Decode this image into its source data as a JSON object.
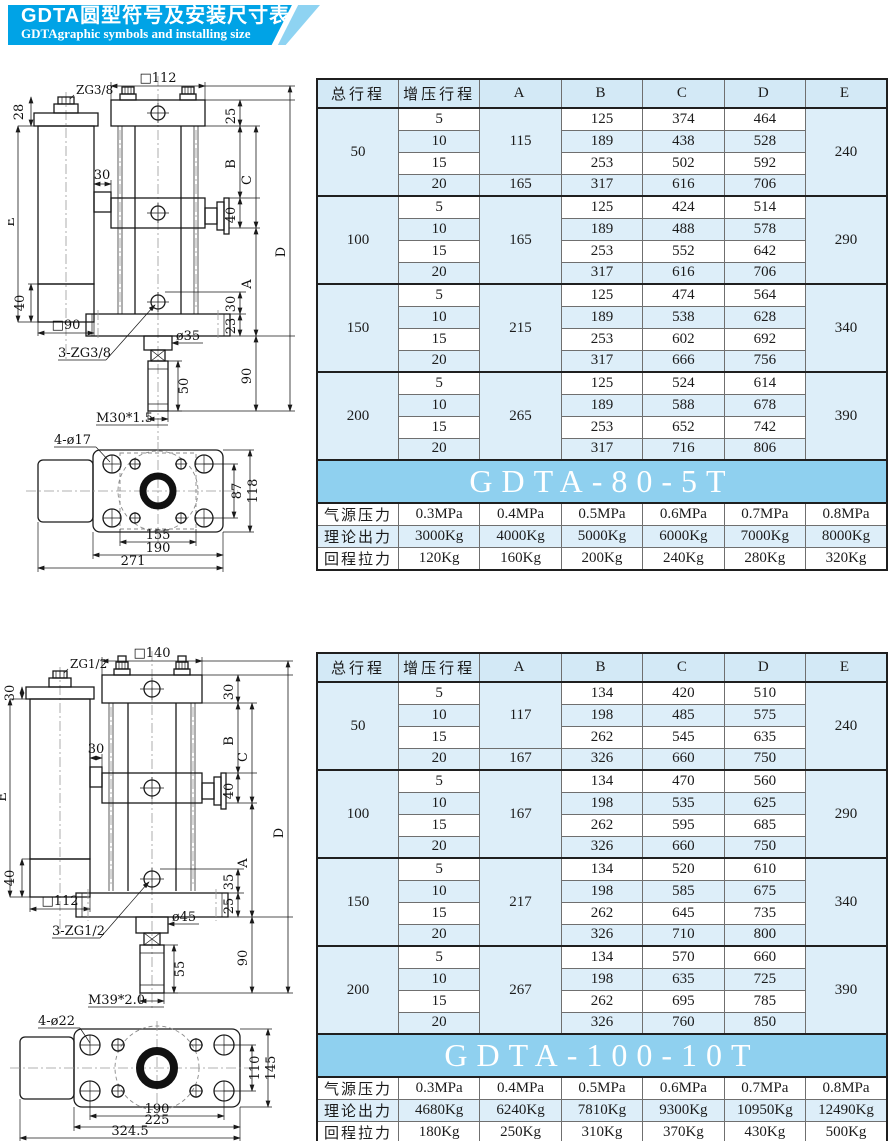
{
  "header": {
    "title_cn": "GDTA圆型符号及安装尺寸表",
    "title_en": "GDTAgraphic symbols and installing size"
  },
  "colors": {
    "header_blue": "#00a3e6",
    "header_triangle": "#8ed3f2",
    "table_header_bg": "#d3e9f6",
    "row_alt_bg": "#ddeef9",
    "banner_bg": "#8fd0ef",
    "line": "#1a1a1a"
  },
  "tables": [
    {
      "columns": [
        "总行程",
        "增压行程",
        "A",
        "B",
        "C",
        "D",
        "E"
      ],
      "groups": [
        {
          "total": "50",
          "e": "240",
          "a_cells": [
            {
              "v": "115",
              "span": 3
            },
            {
              "v": "165",
              "span": 1
            }
          ],
          "rows": [
            [
              "5",
              "125",
              "374",
              "464"
            ],
            [
              "10",
              "189",
              "438",
              "528"
            ],
            [
              "15",
              "253",
              "502",
              "592"
            ],
            [
              "20",
              "317",
              "616",
              "706"
            ]
          ]
        },
        {
          "total": "100",
          "e": "290",
          "a_cells": [
            {
              "v": "165",
              "span": 4
            }
          ],
          "rows": [
            [
              "5",
              "125",
              "424",
              "514"
            ],
            [
              "10",
              "189",
              "488",
              "578"
            ],
            [
              "15",
              "253",
              "552",
              "642"
            ],
            [
              "20",
              "317",
              "616",
              "706"
            ]
          ]
        },
        {
          "total": "150",
          "e": "340",
          "a_cells": [
            {
              "v": "215",
              "span": 4
            }
          ],
          "rows": [
            [
              "5",
              "125",
              "474",
              "564"
            ],
            [
              "10",
              "189",
              "538",
              "628"
            ],
            [
              "15",
              "253",
              "602",
              "692"
            ],
            [
              "20",
              "317",
              "666",
              "756"
            ]
          ]
        },
        {
          "total": "200",
          "e": "390",
          "a_cells": [
            {
              "v": "265",
              "span": 4
            }
          ],
          "rows": [
            [
              "5",
              "125",
              "524",
              "614"
            ],
            [
              "10",
              "189",
              "588",
              "678"
            ],
            [
              "15",
              "253",
              "652",
              "742"
            ],
            [
              "20",
              "317",
              "716",
              "806"
            ]
          ]
        }
      ],
      "model": "GDTA-80-5T",
      "specs": [
        {
          "label": "气源压力",
          "values": [
            "0.3MPa",
            "0.4MPa",
            "0.5MPa",
            "0.6MPa",
            "0.7MPa",
            "0.8MPa"
          ]
        },
        {
          "label": "理论出力",
          "values": [
            "3000Kg",
            "4000Kg",
            "5000Kg",
            "6000Kg",
            "7000Kg",
            "8000Kg"
          ]
        },
        {
          "label": "回程拉力",
          "values": [
            "120Kg",
            "160Kg",
            "200Kg",
            "240Kg",
            "280Kg",
            "320Kg"
          ]
        }
      ]
    },
    {
      "columns": [
        "总行程",
        "增压行程",
        "A",
        "B",
        "C",
        "D",
        "E"
      ],
      "groups": [
        {
          "total": "50",
          "e": "240",
          "a_cells": [
            {
              "v": "117",
              "span": 3
            },
            {
              "v": "167",
              "span": 1
            }
          ],
          "rows": [
            [
              "5",
              "134",
              "420",
              "510"
            ],
            [
              "10",
              "198",
              "485",
              "575"
            ],
            [
              "15",
              "262",
              "545",
              "635"
            ],
            [
              "20",
              "326",
              "660",
              "750"
            ]
          ]
        },
        {
          "total": "100",
          "e": "290",
          "a_cells": [
            {
              "v": "167",
              "span": 4
            }
          ],
          "rows": [
            [
              "5",
              "134",
              "470",
              "560"
            ],
            [
              "10",
              "198",
              "535",
              "625"
            ],
            [
              "15",
              "262",
              "595",
              "685"
            ],
            [
              "20",
              "326",
              "660",
              "750"
            ]
          ]
        },
        {
          "total": "150",
          "e": "340",
          "a_cells": [
            {
              "v": "217",
              "span": 4
            }
          ],
          "rows": [
            [
              "5",
              "134",
              "520",
              "610"
            ],
            [
              "10",
              "198",
              "585",
              "675"
            ],
            [
              "15",
              "262",
              "645",
              "735"
            ],
            [
              "20",
              "326",
              "710",
              "800"
            ]
          ]
        },
        {
          "total": "200",
          "e": "390",
          "a_cells": [
            {
              "v": "267",
              "span": 4
            }
          ],
          "rows": [
            [
              "5",
              "134",
              "570",
              "660"
            ],
            [
              "10",
              "198",
              "635",
              "725"
            ],
            [
              "15",
              "262",
              "695",
              "785"
            ],
            [
              "20",
              "326",
              "760",
              "850"
            ]
          ]
        }
      ],
      "model": "GDTA-100-10T",
      "specs": [
        {
          "label": "气源压力",
          "values": [
            "0.3MPa",
            "0.4MPa",
            "0.5MPa",
            "0.6MPa",
            "0.7MPa",
            "0.8MPa"
          ]
        },
        {
          "label": "理论出力",
          "values": [
            "4680Kg",
            "6240Kg",
            "7810Kg",
            "9300Kg",
            "10950Kg",
            "12490Kg"
          ]
        },
        {
          "label": "回程拉力",
          "values": [
            "180Kg",
            "250Kg",
            "310Kg",
            "370Kg",
            "430Kg",
            "500Kg"
          ]
        }
      ]
    }
  ],
  "drawings": [
    {
      "labels": {
        "zg_top": "ZG3/8",
        "sq_top": "□112",
        "d28": "28",
        "d25": "25",
        "d30_mid": "30",
        "dB": "B",
        "d40_gauge": "40",
        "dC": "C",
        "dD": "D",
        "dE": "E",
        "dA": "A",
        "d40_tank": "40",
        "sq_tank": "□90",
        "ports": "3-ZG3/8",
        "rod_d": "ø35",
        "rod_l": "50",
        "d30_b": "30",
        "d23": "23",
        "d90": "90",
        "thread": "M30*1.5",
        "holes": "4-ø17",
        "d87": "87",
        "d118": "118",
        "d155": "155",
        "d190": "190",
        "d271": "271"
      }
    },
    {
      "labels": {
        "zg_top": "ZG1/2",
        "sq_top": "□140",
        "d30_cap": "30",
        "d30_plate": "30",
        "d30_mid": "30",
        "dB": "B",
        "d40_gauge": "40",
        "dC": "C",
        "dD": "D",
        "dE": "E",
        "dA": "A",
        "d40_tank": "40",
        "sq_tank": "□112",
        "ports": "3-ZG1/2",
        "rod_d": "ø45",
        "rod_l": "55",
        "d35": "35",
        "d25": "25",
        "d90": "90",
        "thread": "M39*2.0",
        "holes": "4-ø22",
        "d110": "110",
        "d145": "145",
        "d190": "190",
        "d225": "225",
        "d324": "324.5"
      }
    }
  ]
}
